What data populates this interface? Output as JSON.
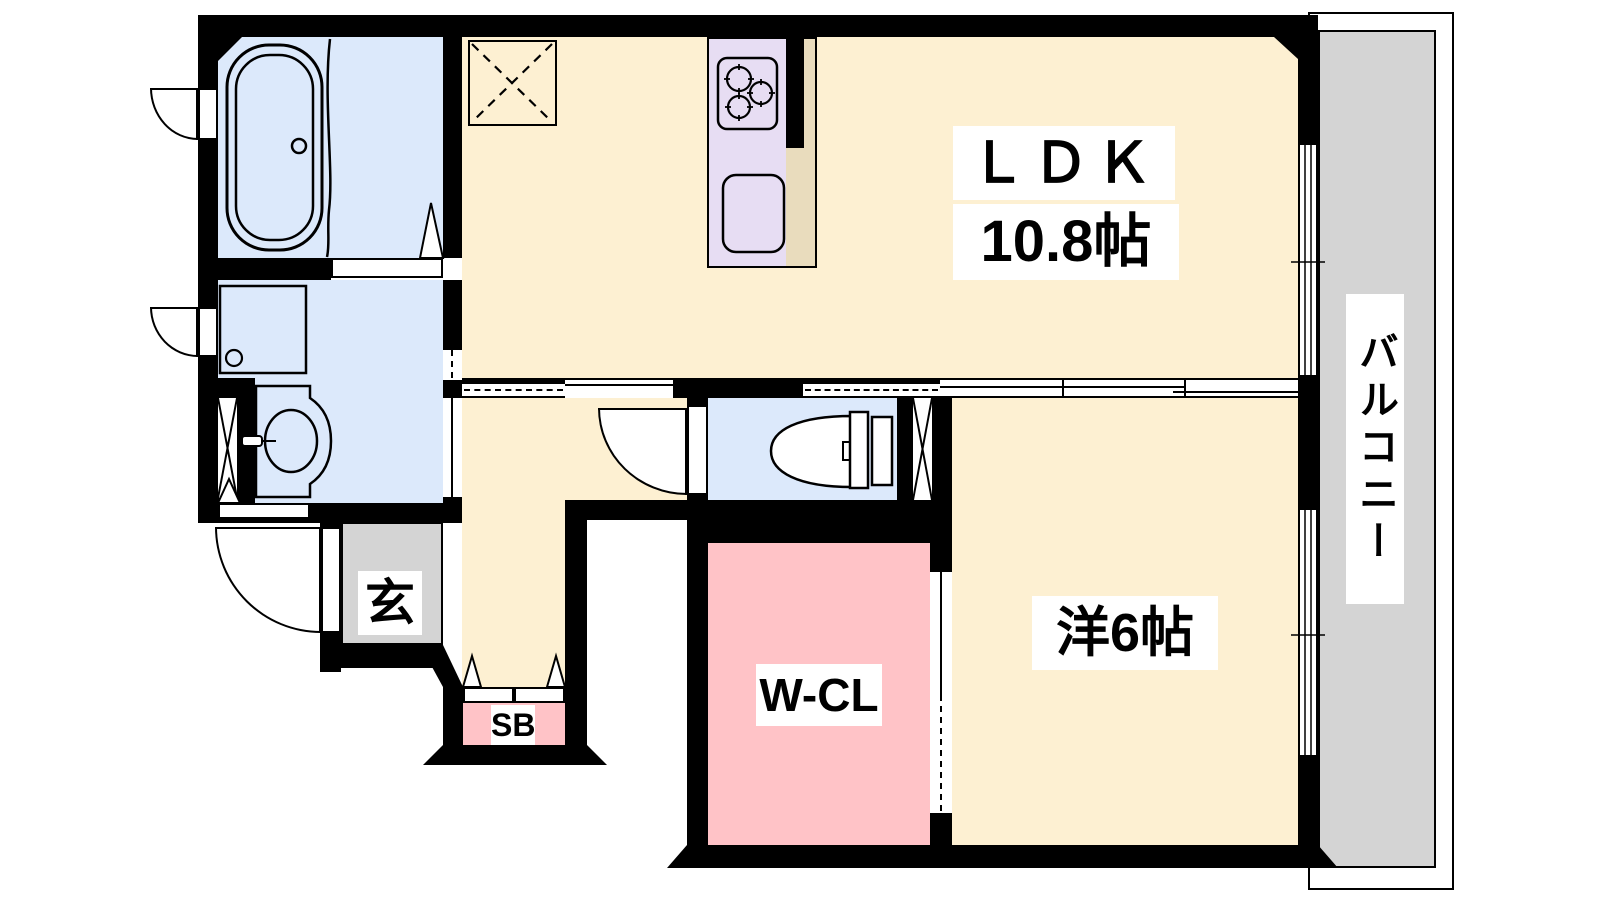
{
  "plan_title": "apartment-floor-plan",
  "labels": {
    "ldk": "ＬＤＫ",
    "ldk_size": "10.8帖",
    "western_room": "洋6帖",
    "walk_in_closet": "W-CL",
    "entrance": "玄",
    "shoe_box": "SB",
    "balcony": "バルコニー"
  },
  "colors": {
    "page-white": "#ffffff",
    "floor-cream": "#fdf0d2",
    "wet-blue": "#dce9fb",
    "kitchen-lavender": "#e7ddf3",
    "counter-tan": "#e9dcbd",
    "closet-pink": "#ffc3c7",
    "area-gray": "#d4d4d4",
    "wall-black": "#000000"
  },
  "fixtures": {
    "bathtub": "bathtub",
    "washing_machine": "washing-machine-pan",
    "washbasin": "washbasin",
    "toilet": "toilet",
    "stove": "gas-stove",
    "sink": "kitchen-sink",
    "refrigerator": "refrigerator-space"
  }
}
